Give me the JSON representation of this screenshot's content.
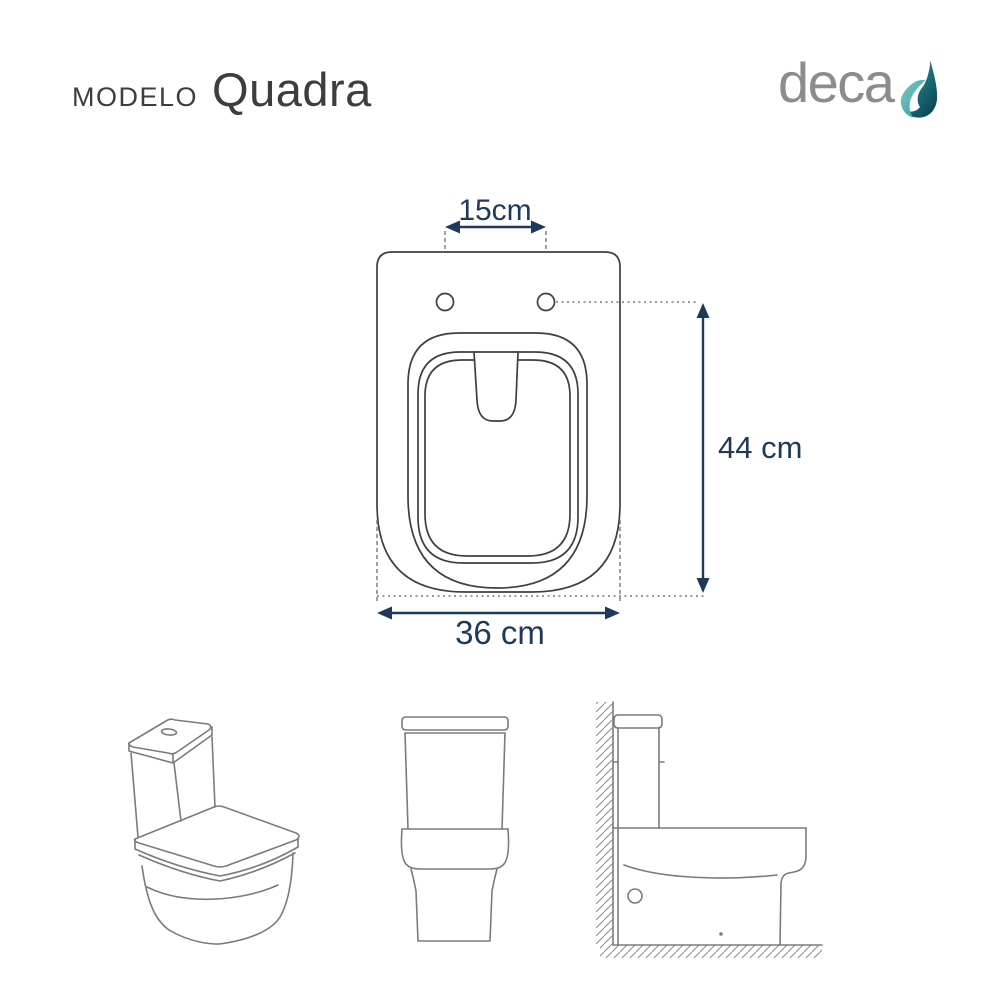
{
  "header": {
    "model_label": "MODELO",
    "model_name": "Quadra",
    "brand_wordmark": "deca"
  },
  "top_view": {
    "dimensions": {
      "hinge_spacing": "15cm",
      "length": "44 cm",
      "width": "36 cm"
    }
  },
  "bottom_views": {
    "items": [
      {
        "name": "perspective-view"
      },
      {
        "name": "front-view"
      },
      {
        "name": "side-view"
      }
    ]
  },
  "colors": {
    "background": "#ffffff",
    "title_text": "#3d3d3d",
    "brand_text": "#8c8c8c",
    "drop_teal_light": "#7ecac5",
    "drop_teal_mid": "#2f98a0",
    "drop_teal_dark": "#0b4656",
    "drawing_line": "#3f3f3f",
    "helper_line": "#787878",
    "dimension_color": "#1e3a58",
    "views_line": "#7b7b7b"
  }
}
